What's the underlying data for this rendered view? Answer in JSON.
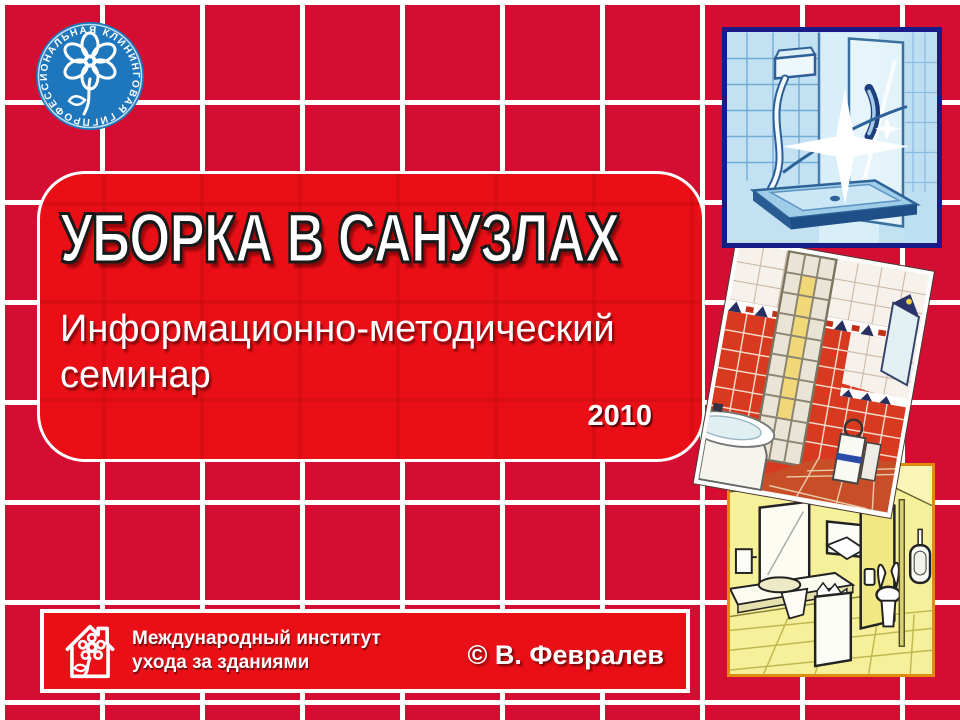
{
  "logo": {
    "ring_text": "ПРОФЕССИОНАЛЬНАЯ КЛИНИНГОВАЯ ГИГИЕНА"
  },
  "panel": {
    "title": "УБОРКА В САНУЗЛАХ",
    "subtitle": "Информационно-методический семинар",
    "year": "2010"
  },
  "footer": {
    "org_line1": "Международный институт",
    "org_line2": "ухода за зданиями",
    "copyright": "© В. Февралев"
  },
  "illustrations": [
    {
      "name": "shower-cabin"
    },
    {
      "name": "tiled-bathroom"
    },
    {
      "name": "public-restroom"
    }
  ],
  "colors": {
    "background_tile": "#D40E33",
    "grout": "#FFFFFF",
    "panel_red": "#EA0F16",
    "logo_blue": "#1E76BC",
    "shower_border": "#191B88",
    "restroom_border": "#E08A10"
  }
}
